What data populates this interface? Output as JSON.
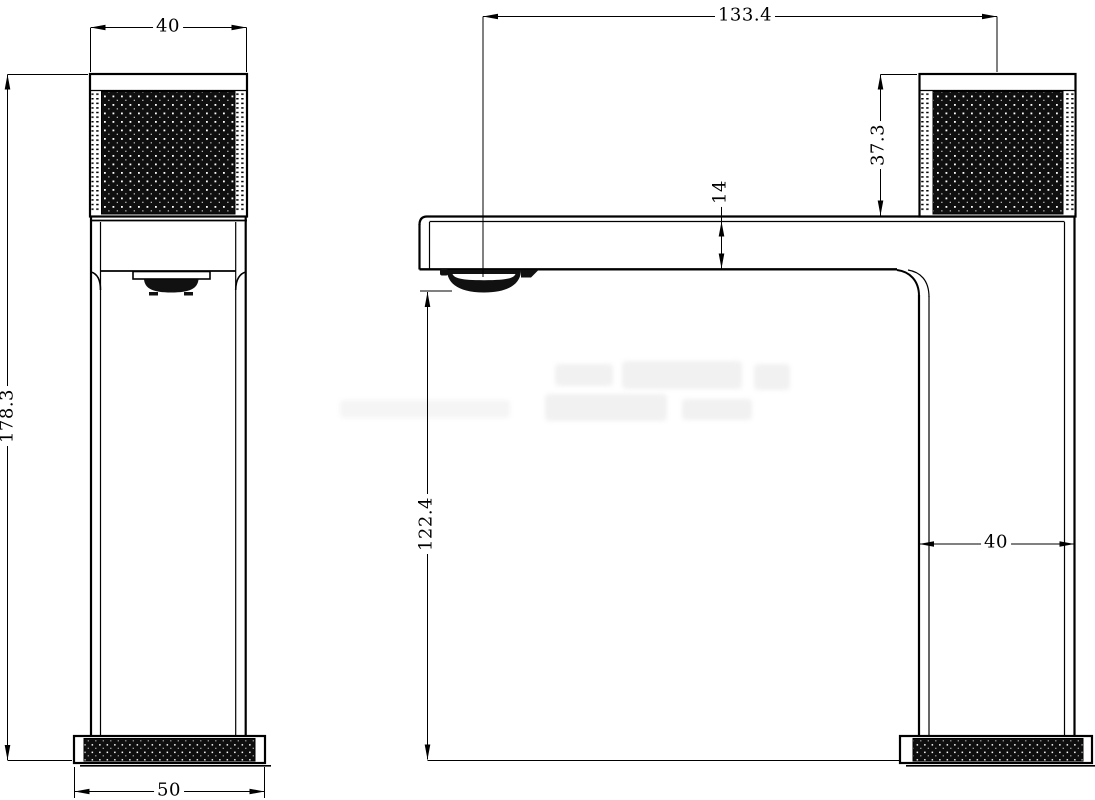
{
  "drawing": {
    "type": "technical-drawing",
    "subject": "basin faucet, two orthographic views with dimensions",
    "colors": {
      "line": "#000000",
      "bg": "#ffffff",
      "knurl": "#0f0f0f"
    },
    "dims": {
      "handle_width": "40",
      "overall_height": "178.3",
      "base_width_front": "50",
      "spout_reach": "133.4",
      "handle_height": "37.3",
      "spout_thickness": "14",
      "spout_clearance": "122.4",
      "body_width_side": "40"
    }
  }
}
